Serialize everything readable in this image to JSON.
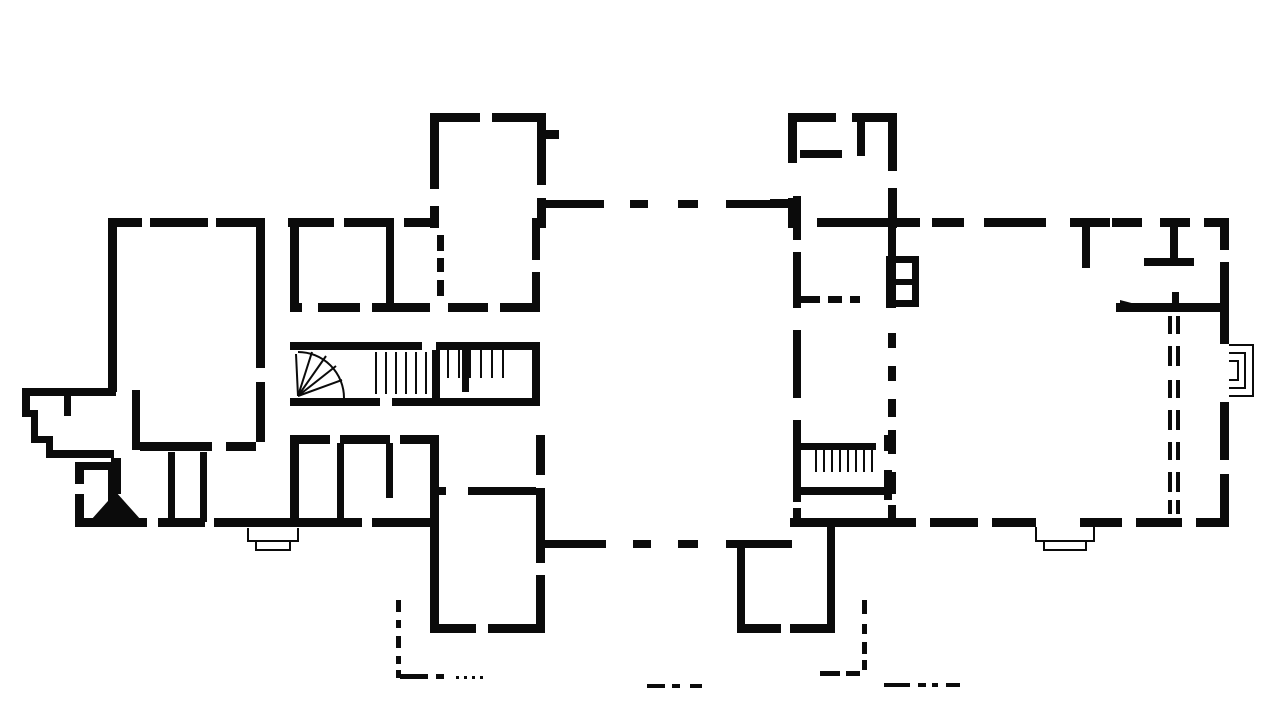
{
  "meta": {
    "drawing_type": "architectural-floor-plan",
    "style": "scanned black ink on white",
    "background": "#ffffff",
    "ink": "#0b0b0b",
    "width": 1280,
    "height": 717
  },
  "plan": {
    "walls": [
      [
        430,
        113,
        50,
        9
      ],
      [
        492,
        113,
        54,
        9
      ],
      [
        430,
        113,
        9,
        76
      ],
      [
        430,
        206,
        9,
        22
      ],
      [
        537,
        113,
        9,
        72
      ],
      [
        546,
        130,
        13,
        9
      ],
      [
        537,
        198,
        9,
        30
      ],
      [
        788,
        113,
        48,
        9
      ],
      [
        852,
        113,
        45,
        9
      ],
      [
        788,
        113,
        9,
        50
      ],
      [
        788,
        198,
        9,
        30
      ],
      [
        888,
        113,
        9,
        58
      ],
      [
        888,
        188,
        9,
        40
      ],
      [
        800,
        150,
        42,
        8
      ],
      [
        857,
        121,
        8,
        35
      ],
      [
        770,
        199,
        18,
        8
      ],
      [
        540,
        200,
        64,
        8
      ],
      [
        726,
        200,
        64,
        8
      ],
      [
        108,
        218,
        34,
        9
      ],
      [
        150,
        218,
        58,
        9
      ],
      [
        216,
        218,
        48,
        9
      ],
      [
        108,
        218,
        9,
        174
      ],
      [
        108,
        462,
        9,
        65
      ],
      [
        256,
        218,
        9,
        150
      ],
      [
        256,
        382,
        9,
        60
      ],
      [
        140,
        442,
        72,
        9
      ],
      [
        226,
        442,
        30,
        9
      ],
      [
        132,
        390,
        8,
        60
      ],
      [
        168,
        452,
        7,
        70
      ],
      [
        200,
        452,
        7,
        70
      ],
      [
        75,
        518,
        72,
        9
      ],
      [
        158,
        518,
        47,
        9
      ],
      [
        214,
        518,
        86,
        9
      ],
      [
        75,
        462,
        9,
        22
      ],
      [
        75,
        494,
        9,
        33
      ],
      [
        75,
        462,
        35,
        8
      ],
      [
        22,
        388,
        94,
        8
      ],
      [
        22,
        388,
        8,
        28
      ],
      [
        22,
        410,
        16,
        7
      ],
      [
        31,
        410,
        7,
        33
      ],
      [
        31,
        436,
        22,
        7
      ],
      [
        46,
        436,
        7,
        20
      ],
      [
        46,
        450,
        68,
        8
      ],
      [
        64,
        388,
        7,
        28
      ],
      [
        288,
        218,
        46,
        9
      ],
      [
        344,
        218,
        50,
        9
      ],
      [
        404,
        218,
        30,
        9
      ],
      [
        290,
        218,
        9,
        94
      ],
      [
        386,
        222,
        8,
        88
      ],
      [
        290,
        303,
        12,
        9
      ],
      [
        318,
        303,
        42,
        9
      ],
      [
        372,
        303,
        58,
        9
      ],
      [
        448,
        303,
        40,
        9
      ],
      [
        500,
        303,
        40,
        9
      ],
      [
        532,
        218,
        8,
        42
      ],
      [
        532,
        272,
        8,
        40
      ],
      [
        290,
        342,
        132,
        8
      ],
      [
        436,
        342,
        97,
        8
      ],
      [
        290,
        398,
        90,
        8
      ],
      [
        392,
        398,
        146,
        8
      ],
      [
        532,
        342,
        8,
        64
      ],
      [
        432,
        350,
        8,
        48
      ],
      [
        462,
        350,
        7,
        42
      ],
      [
        290,
        435,
        40,
        9
      ],
      [
        340,
        435,
        50,
        9
      ],
      [
        400,
        435,
        32,
        9
      ],
      [
        290,
        435,
        9,
        90
      ],
      [
        337,
        443,
        7,
        78
      ],
      [
        386,
        443,
        7,
        55
      ],
      [
        300,
        518,
        62,
        9
      ],
      [
        372,
        518,
        58,
        9
      ],
      [
        430,
        435,
        9,
        197
      ],
      [
        536,
        435,
        9,
        40
      ],
      [
        536,
        488,
        9,
        75
      ],
      [
        536,
        575,
        9,
        57
      ],
      [
        430,
        487,
        16,
        8
      ],
      [
        468,
        487,
        68,
        8
      ],
      [
        430,
        624,
        46,
        9
      ],
      [
        488,
        624,
        57,
        9
      ],
      [
        544,
        540,
        62,
        8
      ],
      [
        726,
        540,
        66,
        8
      ],
      [
        737,
        548,
        8,
        84
      ],
      [
        827,
        518,
        8,
        114
      ],
      [
        737,
        624,
        44,
        9
      ],
      [
        790,
        624,
        45,
        9
      ],
      [
        790,
        518,
        108,
        9
      ],
      [
        793,
        196,
        8,
        44
      ],
      [
        793,
        252,
        8,
        56
      ],
      [
        793,
        330,
        8,
        68
      ],
      [
        793,
        420,
        8,
        82
      ],
      [
        793,
        508,
        8,
        19
      ],
      [
        817,
        218,
        83,
        9
      ],
      [
        800,
        443,
        76,
        7
      ],
      [
        800,
        487,
        92,
        8
      ],
      [
        884,
        435,
        8,
        16
      ],
      [
        884,
        470,
        8,
        30
      ],
      [
        886,
        256,
        10,
        52
      ],
      [
        886,
        256,
        32,
        7
      ],
      [
        886,
        279,
        32,
        6
      ],
      [
        886,
        300,
        32,
        7
      ],
      [
        912,
        256,
        7,
        51
      ],
      [
        888,
        218,
        8,
        40
      ],
      [
        888,
        505,
        8,
        22
      ],
      [
        898,
        218,
        22,
        9
      ],
      [
        932,
        218,
        32,
        9
      ],
      [
        984,
        218,
        62,
        9
      ],
      [
        1070,
        218,
        40,
        9
      ],
      [
        1112,
        218,
        30,
        9
      ],
      [
        1160,
        218,
        30,
        9
      ],
      [
        1204,
        218,
        25,
        9
      ],
      [
        1220,
        218,
        9,
        32
      ],
      [
        1220,
        262,
        9,
        82
      ],
      [
        1220,
        402,
        9,
        58
      ],
      [
        1220,
        474,
        9,
        53
      ],
      [
        888,
        518,
        28,
        9
      ],
      [
        930,
        518,
        48,
        9
      ],
      [
        992,
        518,
        44,
        9
      ],
      [
        1080,
        518,
        42,
        9
      ],
      [
        1136,
        518,
        46,
        9
      ],
      [
        1196,
        518,
        33,
        9
      ],
      [
        1082,
        222,
        8,
        46
      ],
      [
        1144,
        258,
        50,
        8
      ],
      [
        1170,
        220,
        8,
        42
      ],
      [
        1116,
        303,
        112,
        9
      ],
      [
        1172,
        292,
        7,
        20
      ],
      [
        111,
        458,
        10,
        36
      ]
    ],
    "dashes": [
      [
        630,
        200,
        18,
        8
      ],
      [
        678,
        200,
        20,
        8
      ],
      [
        633,
        540,
        18,
        8
      ],
      [
        678,
        540,
        20,
        8
      ],
      [
        437,
        235,
        7,
        16
      ],
      [
        437,
        258,
        7,
        14
      ],
      [
        437,
        280,
        7,
        16
      ],
      [
        800,
        296,
        20,
        7
      ],
      [
        828,
        296,
        14,
        7
      ],
      [
        850,
        296,
        10,
        7
      ],
      [
        888,
        333,
        8,
        15
      ],
      [
        888,
        366,
        8,
        15
      ],
      [
        888,
        399,
        8,
        18
      ],
      [
        888,
        430,
        8,
        24
      ],
      [
        888,
        472,
        8,
        22
      ],
      [
        1168,
        316,
        4,
        18
      ],
      [
        1168,
        346,
        4,
        20
      ],
      [
        1168,
        380,
        4,
        18
      ],
      [
        1168,
        410,
        4,
        20
      ],
      [
        1168,
        442,
        4,
        18
      ],
      [
        1168,
        472,
        4,
        20
      ],
      [
        1168,
        500,
        4,
        14
      ],
      [
        1176,
        316,
        4,
        18
      ],
      [
        1176,
        346,
        4,
        20
      ],
      [
        1176,
        380,
        4,
        18
      ],
      [
        1176,
        410,
        4,
        20
      ],
      [
        1176,
        442,
        4,
        18
      ],
      [
        1176,
        472,
        4,
        20
      ],
      [
        1176,
        500,
        4,
        14
      ],
      [
        396,
        600,
        5,
        12
      ],
      [
        396,
        620,
        5,
        8
      ],
      [
        396,
        636,
        5,
        12
      ],
      [
        396,
        656,
        5,
        8
      ],
      [
        396,
        670,
        5,
        8
      ],
      [
        400,
        674,
        28,
        5
      ],
      [
        436,
        674,
        8,
        5
      ],
      [
        456,
        676,
        3,
        3
      ],
      [
        464,
        676,
        3,
        3
      ],
      [
        472,
        676,
        3,
        3
      ],
      [
        480,
        676,
        3,
        3
      ],
      [
        820,
        671,
        20,
        5
      ],
      [
        846,
        671,
        14,
        5
      ],
      [
        862,
        600,
        5,
        14
      ],
      [
        862,
        624,
        5,
        10
      ],
      [
        862,
        642,
        5,
        12
      ],
      [
        862,
        660,
        5,
        10
      ],
      [
        884,
        683,
        26,
        4
      ],
      [
        918,
        683,
        8,
        4
      ],
      [
        932,
        683,
        6,
        4
      ],
      [
        946,
        683,
        14,
        4
      ],
      [
        647,
        684,
        18,
        4
      ],
      [
        672,
        684,
        8,
        4
      ],
      [
        690,
        684,
        12,
        4
      ]
    ],
    "dots": [
      [
        445,
        70,
        9
      ],
      [
        513,
        70,
        9
      ],
      [
        586,
        70,
        9
      ],
      [
        729,
        70,
        9
      ],
      [
        802,
        70,
        9
      ],
      [
        872,
        70,
        9
      ],
      [
        136,
        133,
        8
      ],
      [
        179,
        133,
        8
      ],
      [
        223,
        133,
        8
      ],
      [
        268,
        133,
        8
      ],
      [
        311,
        133,
        8
      ],
      [
        356,
        133,
        8
      ],
      [
        396,
        133,
        8
      ],
      [
        924,
        133,
        8
      ],
      [
        968,
        133,
        8
      ],
      [
        1016,
        133,
        8
      ],
      [
        1059,
        133,
        8
      ],
      [
        1106,
        133,
        8
      ],
      [
        1153,
        133,
        8
      ],
      [
        1196,
        133,
        8
      ],
      [
        208,
        265,
        8
      ],
      [
        208,
        309,
        8
      ],
      [
        208,
        351,
        8
      ],
      [
        208,
        393,
        8
      ],
      [
        941,
        305,
        8
      ],
      [
        991,
        305,
        8
      ],
      [
        1036,
        305,
        8
      ],
      [
        941,
        432,
        8
      ],
      [
        991,
        432,
        8
      ],
      [
        1036,
        432,
        8
      ],
      [
        1081,
        432,
        8
      ],
      [
        1126,
        432,
        8
      ],
      [
        559,
        609,
        8
      ],
      [
        603,
        609,
        8
      ],
      [
        644,
        609,
        8
      ],
      [
        684,
        609,
        8
      ],
      [
        438,
        665,
        9
      ],
      [
        498,
        665,
        9
      ],
      [
        559,
        665,
        8
      ],
      [
        683,
        665,
        9
      ],
      [
        747,
        666,
        7
      ],
      [
        808,
        665,
        9
      ]
    ],
    "stair_treads": [
      [
        448,
        350,
        448,
        378,
        2
      ],
      [
        459,
        350,
        459,
        378,
        2
      ],
      [
        470,
        350,
        470,
        378,
        2
      ],
      [
        481,
        350,
        481,
        378,
        2
      ],
      [
        492,
        350,
        492,
        378,
        2
      ],
      [
        503,
        350,
        503,
        378,
        2
      ],
      [
        376,
        352,
        376,
        394,
        2
      ],
      [
        386,
        352,
        386,
        394,
        2
      ],
      [
        396,
        352,
        396,
        394,
        2
      ],
      [
        406,
        352,
        406,
        394,
        2
      ],
      [
        416,
        352,
        416,
        394,
        2
      ],
      [
        426,
        352,
        426,
        394,
        2
      ],
      [
        816,
        450,
        816,
        472,
        2
      ],
      [
        824,
        450,
        824,
        472,
        2
      ],
      [
        832,
        450,
        832,
        472,
        2
      ],
      [
        840,
        450,
        840,
        472,
        2
      ],
      [
        848,
        450,
        848,
        472,
        2
      ],
      [
        856,
        450,
        856,
        472,
        2
      ],
      [
        864,
        450,
        864,
        472,
        2
      ],
      [
        872,
        450,
        872,
        472,
        2
      ],
      [
        298,
        396,
        296,
        354,
        2
      ],
      [
        298,
        396,
        312,
        352,
        2
      ],
      [
        298,
        396,
        326,
        356,
        2
      ],
      [
        298,
        396,
        336,
        366,
        2
      ],
      [
        298,
        396,
        342,
        380,
        2
      ]
    ],
    "outline_paths": [
      "M344,398 A46,46 0 0 0 298,352",
      "M1229,345 h24 v51 h-24",
      "M1229,353 h16 v35 h-16",
      "M1229,361 h9 v19 h-9",
      "M1036,527 v14 h58 v-14",
      "M1044,541 v9 h42 v-9",
      "M248,528 v13 h50 v-13",
      "M256,541 v9 h34 v-9"
    ],
    "polygons": [
      [
        [
          91,
          520
        ],
        [
          141,
          520
        ],
        [
          116,
          492
        ]
      ],
      [
        [
          1120,
          300
        ],
        [
          1143,
          306
        ],
        [
          1120,
          312
        ]
      ]
    ]
  }
}
